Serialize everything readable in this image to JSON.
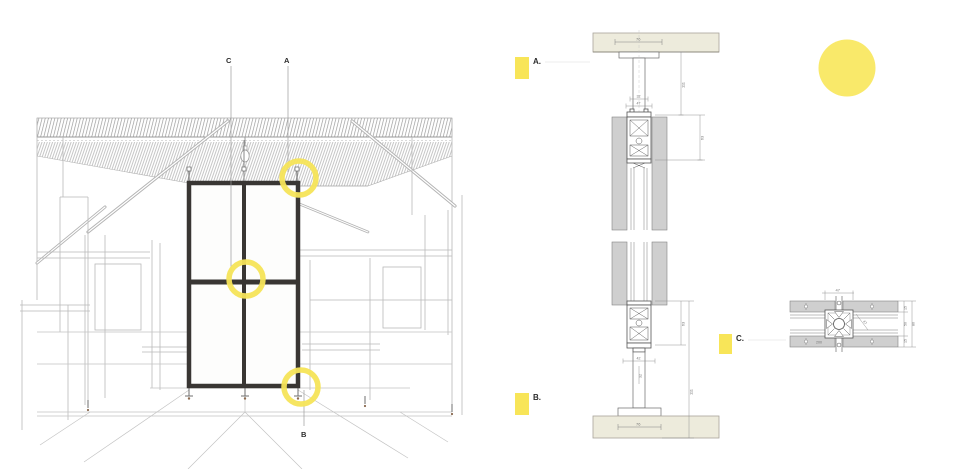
{
  "sheet": {
    "description": "architectural partition system detail sheet",
    "background": "#ffffff"
  },
  "colors": {
    "highlight_yellow": "#F8E558",
    "highlight_circle": "#F9E96A",
    "frame_dark": "#393633",
    "slab_cream": "#EDEBDC",
    "panel_gray": "#CFCFCF",
    "drawing_gray": "#9A9A9A"
  },
  "perspective": {
    "callout_c": "C",
    "callout_a": "A",
    "callout_b": "B"
  },
  "markers": {
    "a": "A.",
    "b": "B.",
    "c": "C."
  },
  "vertical_section": {
    "dims": {
      "ceiling_width": "76",
      "head_gap": "32",
      "head_width": "47",
      "drop_height": "111",
      "head_profile": "63",
      "sill_profile": "63",
      "sill_height": "111",
      "stem_width": "42",
      "stem_height": "32",
      "base_width": "76"
    }
  },
  "plan_section": {
    "dims": {
      "profile_width": "47",
      "profile_diagonal": "47",
      "panel_length": "200",
      "side_top": "15",
      "side_mid": "50",
      "side_bot": "15",
      "overall": "80"
    }
  }
}
